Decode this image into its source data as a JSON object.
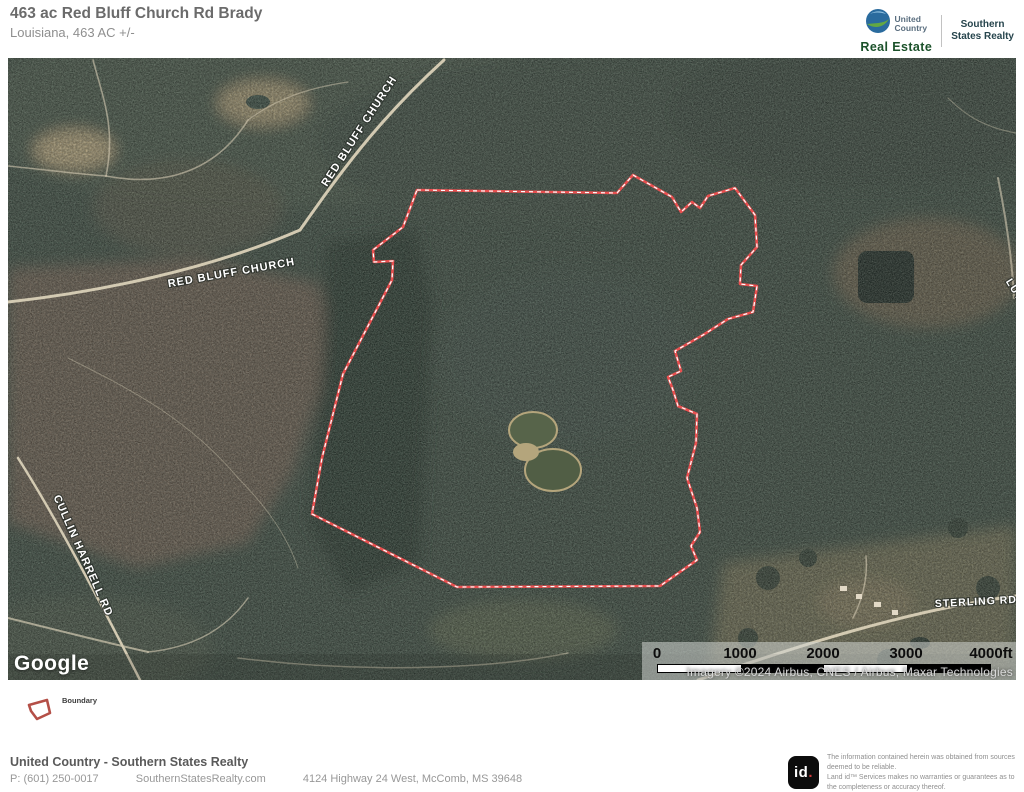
{
  "header": {
    "title": "463 ac Red Bluff Church Rd Brady",
    "subtitle": "Louisiana, 463 AC +/-",
    "brand": {
      "united": "United",
      "country": "Country",
      "real_estate": "Real Estate",
      "southern": "Southern",
      "states_realty": "States Realty"
    }
  },
  "map": {
    "labels": {
      "red_bluff_diagonal": "RED BLUFF CHURCH",
      "red_bluff_horizontal": "RED BLUFF CHURCH",
      "cullin_harrell": "CULLIN HARRELL RD",
      "sterling": "STERLING RD",
      "luther_partial": "LUTH"
    },
    "google_logo": "Google",
    "attribution": "Imagery ©2024 Airbus, CNES / Airbus, Maxar Technologies",
    "scale": {
      "ticks": [
        "0",
        "1000",
        "2000",
        "3000",
        "4000ft"
      ]
    }
  },
  "legend": {
    "boundary_label": "Boundary"
  },
  "footer": {
    "company": "United Country - Southern States Realty",
    "phone": "P: (601) 250-0017",
    "website": "SouthernStatesRealty.com",
    "address": "4124 Highway 24 West, McComb, MS 39648",
    "land_id_logo_text": "id",
    "land_id_logo_dot": ".",
    "disclaimer_line1": "The information contained herein was obtained from sources deemed to be reliable.",
    "disclaimer_line2": "Land id™ Services makes no warranties or guarantees as to the completeness or accuracy thereof."
  },
  "colors": {
    "boundary_red": "#e94f4f",
    "legend_icon_red": "#b44f47",
    "brand_green": "#1b512a",
    "brand_slate": "#27454d",
    "title_gray": "#6b6b6b"
  }
}
